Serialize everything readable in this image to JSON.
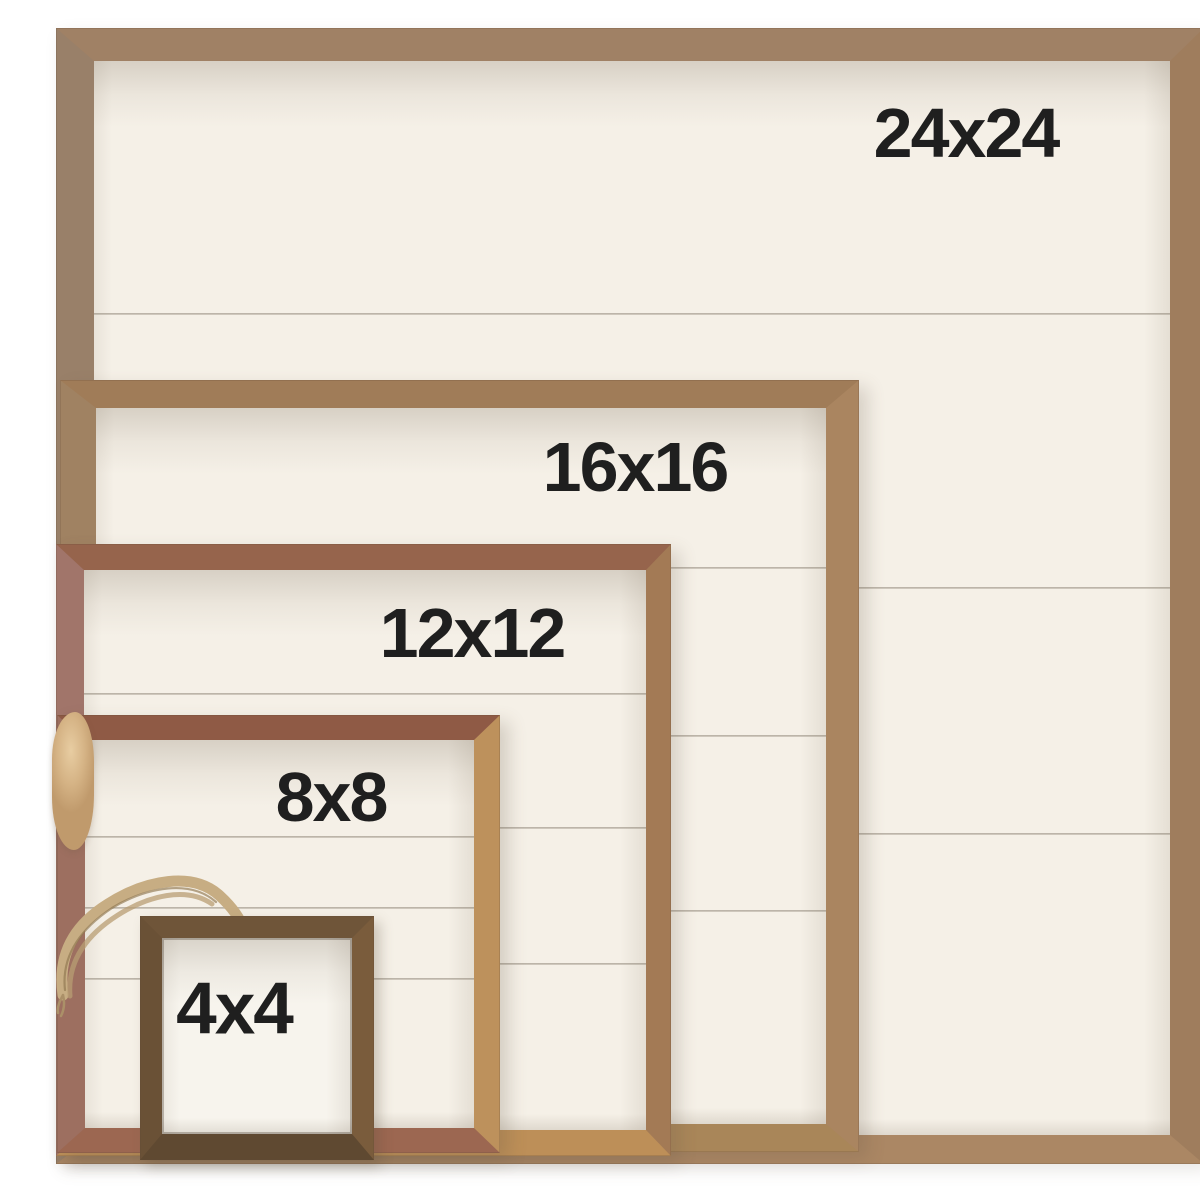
{
  "photo": {
    "subject": "Five nested rustic wood shiplap sign frames, aligned at the bottom-left, each labeled with its size",
    "background_color": "#ffffff",
    "board_color": "#f5f0e7",
    "groove_color": "#7d7364",
    "label_text_color": "#1f1f1f",
    "twine_color": "#c7ad83"
  },
  "frames": [
    {
      "size_label": "24x24",
      "wood_color": "#a08165"
    },
    {
      "size_label": "16x16",
      "wood_color": "#a07c58"
    },
    {
      "size_label": "12x12",
      "wood_color": "#96644c"
    },
    {
      "size_label": "8x8",
      "wood_color": "#8f5a45"
    },
    {
      "size_label": "4x4",
      "wood_color": "#6f5539"
    }
  ]
}
